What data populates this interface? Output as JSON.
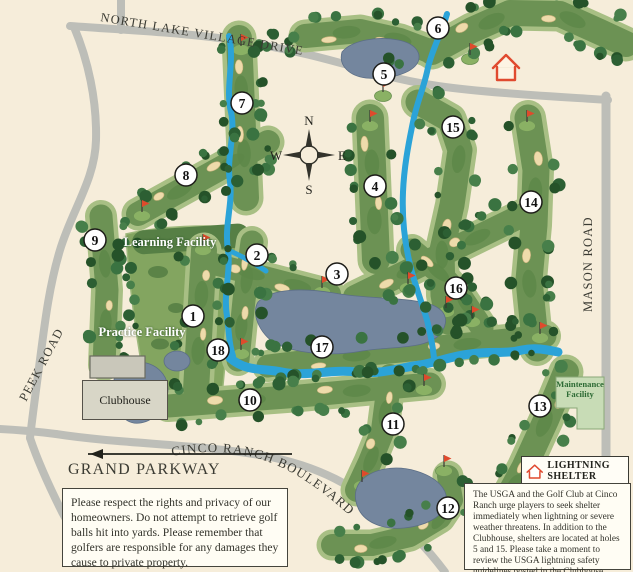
{
  "roads": {
    "north_lake_village_drive": "NORTH LAKE VILLAGE DRIVE",
    "peek_road": "PEEK ROAD",
    "mason_road": "MASON ROAD",
    "grand_parkway": "GRAND PARKWAY",
    "cinco_ranch_boulevard": "CINCO RANCH BOULEVARD"
  },
  "compass": {
    "north": "N",
    "south": "S",
    "east": "E",
    "west": "W"
  },
  "facilities": {
    "learning": "Learning Facility",
    "practice": "Practice Facility",
    "clubhouse": "Clubhouse",
    "maintenance": "Maintenance Facility"
  },
  "legend": {
    "lightning_shelter": "LIGHTNING SHELTER"
  },
  "holes": [
    {
      "number": "1",
      "x": 193,
      "y": 316
    },
    {
      "number": "2",
      "x": 257,
      "y": 255
    },
    {
      "number": "3",
      "x": 337,
      "y": 274
    },
    {
      "number": "4",
      "x": 375,
      "y": 186
    },
    {
      "number": "5",
      "x": 384,
      "y": 74
    },
    {
      "number": "6",
      "x": 438,
      "y": 28
    },
    {
      "number": "7",
      "x": 242,
      "y": 103
    },
    {
      "number": "8",
      "x": 186,
      "y": 175
    },
    {
      "number": "9",
      "x": 95,
      "y": 240
    },
    {
      "number": "10",
      "x": 250,
      "y": 400
    },
    {
      "number": "11",
      "x": 393,
      "y": 424
    },
    {
      "number": "12",
      "x": 448,
      "y": 508
    },
    {
      "number": "13",
      "x": 540,
      "y": 406
    },
    {
      "number": "14",
      "x": 531,
      "y": 202
    },
    {
      "number": "15",
      "x": 453,
      "y": 127
    },
    {
      "number": "16",
      "x": 456,
      "y": 288
    },
    {
      "number": "17",
      "x": 322,
      "y": 347
    },
    {
      "number": "18",
      "x": 218,
      "y": 350
    }
  ],
  "notices": {
    "homeowners": "Please respect the rights and privacy of our homeowners. Do not attempt to retrieve golf balls hit into yards. Please remember that golfers are responsible for any damages they cause to private property.",
    "lightning": "The USGA and the Golf Club at Cinco Ranch urge players to seek shelter immediately when lightning or severe weather threatens. In addition to the Clubhouse, shelters are located at holes 5 and 15. Please take a moment to review the USGA lightning safety guidelines posted in the Clubhouse before beginning play."
  },
  "colors": {
    "background": "#f6edda",
    "road": "#bdbeb8",
    "creek": "#2ba3d8",
    "lake": "#74869e",
    "lake_edge": "#5b6e86",
    "rough": "#a8bf84",
    "fairway": "#6c9254",
    "fairway_dark": "#5d8747",
    "sand": "#eedbab",
    "flag_red": "#df4a2c",
    "shelter_red": "#e04a2f",
    "pad": "#83a560",
    "pad_dark": "#567f45"
  }
}
